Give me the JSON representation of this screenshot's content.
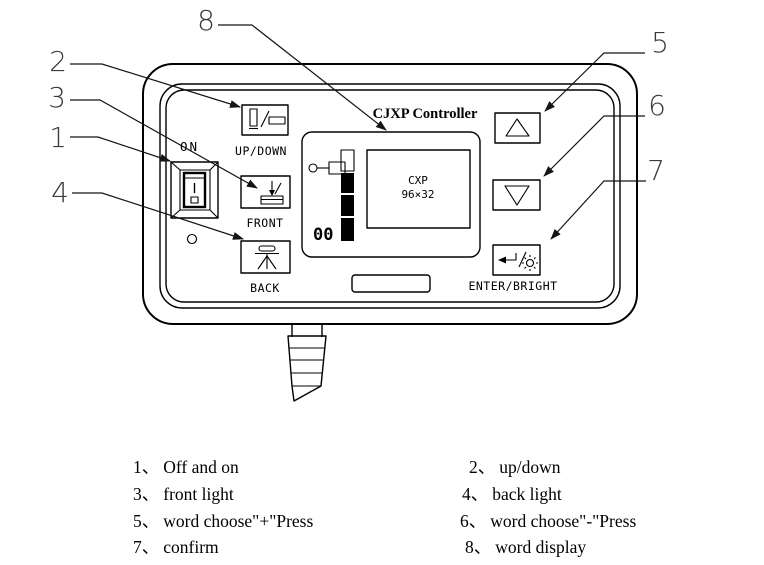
{
  "device": {
    "title": "CJXP Controller",
    "power_switch_label": "ON",
    "updown_button_label": "UP/DOWN",
    "front_button_label": "FRONT",
    "back_button_label": "BACK",
    "enter_button_label": "ENTER/BRIGHT",
    "display": {
      "model_line1": "CXP",
      "model_line2": "96×32",
      "counter_value": "00"
    }
  },
  "callout_numbers": [
    "1",
    "2",
    "3",
    "4",
    "5",
    "6",
    "7",
    "8"
  ],
  "legend": {
    "rows": [
      {
        "left": {
          "num": "1、",
          "text": "Off and on"
        },
        "right": {
          "num": "2、",
          "text": "up/down"
        }
      },
      {
        "left": {
          "num": "3、",
          "text": "front light"
        },
        "right": {
          "num": "4、",
          "text": "back light"
        }
      },
      {
        "left": {
          "num": "5、",
          "text": "word choose\"+\"Press"
        },
        "right": {
          "num": "6、",
          "text": "word choose\"-\"Press"
        }
      },
      {
        "left": {
          "num": "7、",
          "text": "confirm"
        },
        "right": {
          "num": "8、",
          "text": "word display"
        }
      }
    ]
  },
  "colors": {
    "ink": "#000000",
    "paper": "#ffffff"
  }
}
